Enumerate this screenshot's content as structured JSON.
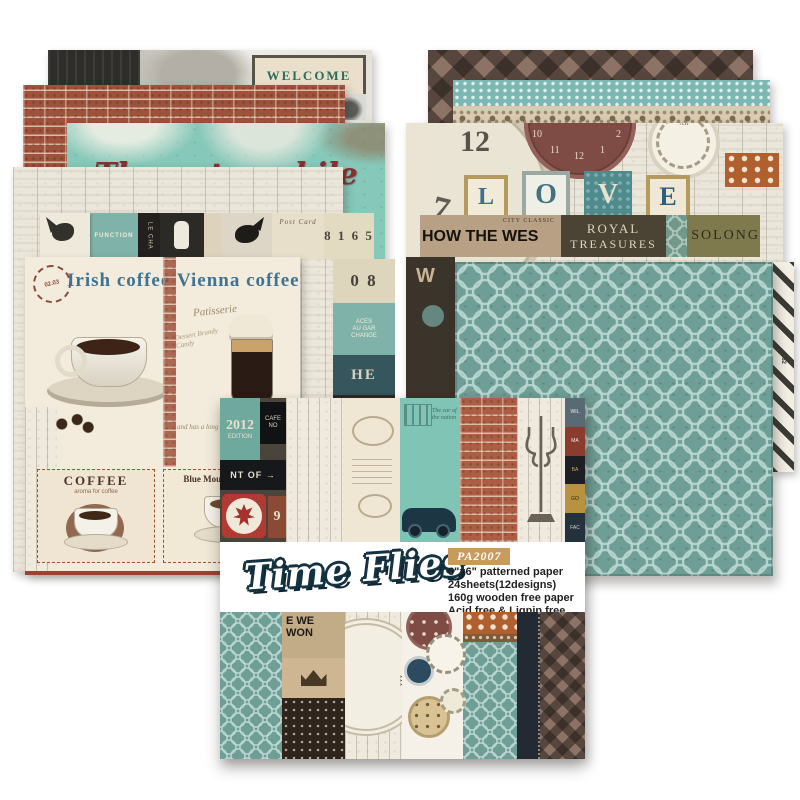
{
  "product": {
    "title": "Time Flies",
    "code": "PA2007",
    "specs": [
      "6\"x6\" patterned paper",
      "24sheets(12designs)",
      "160g wooden free paper",
      "Acid free & Lignin free"
    ]
  },
  "colors": {
    "teal_pattern": "#6f9e96",
    "teal_automobile": "#86c8b9",
    "brick": "#a0513c",
    "navy_outline": "#143240",
    "badge_gold": "#c89a5d",
    "maroon_clock": "#7e4b45",
    "olive_band": "#7e7a4d",
    "dark_band": "#3b342b",
    "cream": "#f2ead8"
  },
  "left_stack": {
    "welcome": {
      "sign": "WELCOME",
      "sign_small": "WELCOME",
      "chalk": "...OU"
    },
    "automobile": {
      "title": "The automobile age"
    },
    "collage": {
      "function_sign": "FUNCTION",
      "le_cha": "LE CHA",
      "post_card": "Post Card",
      "numbers": "8 1 6 5",
      "zero": "0 8",
      "aces": "ACES",
      "au_gar": "AU GAR",
      "change": "CHANGE",
      "he": "HE",
      "meri": "MERI"
    },
    "coffee": {
      "irish": "Irish coffee",
      "vienna": "Vienna coffee",
      "patisserie": "Patisserie",
      "stamp": "02.03",
      "dessert": "Dessert Brandy Candy",
      "history": "and has a long history",
      "coffee_label": "COFFEE",
      "coffee_sub": "aroma for coffee",
      "blue_mountain": "Blue Mountain Coffee."
    }
  },
  "right_stack": {
    "clocks": {
      "love": [
        "L",
        "O",
        "V",
        "E"
      ],
      "city_classic": "CITY CLASSIC",
      "how_the_wes": "HOW THE WES",
      "w": "W",
      "royal": "ROYAL",
      "treasures": "TREASURES",
      "solong": "SOLONG",
      "maroon_numbers": [
        "10",
        "11",
        "12",
        "1",
        "2"
      ],
      "big_numbers": [
        "12",
        "7",
        "2"
      ],
      "ring_numeral": "XII"
    },
    "stripes_text": "382"
  },
  "pack": {
    "top": {
      "y2012": "2012",
      "edition": "EDITION",
      "cafe": "CAFE NO",
      "ntof": "NT OF →",
      "nine": "9",
      "car_script": "The car of the nation",
      "mini_signs": [
        "WIL",
        "MA",
        "BA",
        "GO",
        "FAC"
      ]
    },
    "bottom": {
      "news1": "E WE",
      "news2": "WON",
      "roman": "III"
    }
  }
}
